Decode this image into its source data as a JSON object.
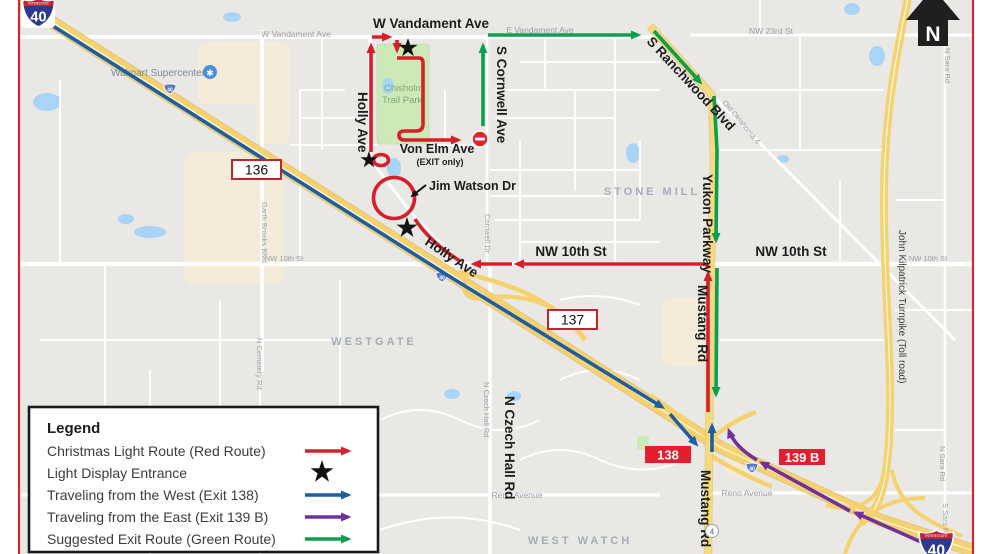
{
  "title": "Christmas light route map",
  "north_label": "N",
  "colors": {
    "red_route": "#d5202c",
    "blue_route": "#1b5ea6",
    "purple_route": "#7030a0",
    "green_route": "#0c9f4d",
    "highway_yellow": "#f6d26e",
    "exit_badge_red": "#e41e2d",
    "map_frame_red": "#cc2b31",
    "water_blue": "#a8d5f5",
    "park_green": "#cdeab6"
  },
  "shields": {
    "interstate_word": "INTERSTATE",
    "i40": "40",
    "box136": "136",
    "box137": "137",
    "exit138": "138",
    "exit139b": "139 B",
    "route4": "4"
  },
  "streets": {
    "w_vandament": "W Vandament Ave",
    "e_vandament": "E Vandament Ave",
    "nw23rd": "NW 23rd St",
    "s_cornwell": "S Cornwell Ave",
    "cornwell_dr": "Cornwell Dr",
    "s_ranchwood": "S Ranchwood Blvd",
    "old_oklahoma4": "Old Oklahoma 4",
    "n_sara": "N Sara Rd",
    "s_sara": "S Sara Rd",
    "holly": "Holly Ave",
    "von_elm": "Von Elm Ave",
    "exit_only": "(EXIT only)",
    "jim_watson": "Jim Watson Dr",
    "garth_brooks": "Garth Brooks Blvd",
    "nw10th": "NW 10th St",
    "yukon_parkway": "Yukon Parkway",
    "mustang_rd": "Mustang Rd",
    "kilpatrick": "John Kilpatrick Turnpike (Toll road)",
    "czech_hall": "N Czech Hall Rd",
    "cemetery": "N Cemetery Rd",
    "reno": "Reno Avenue"
  },
  "pois": {
    "walmart": "Walmart Supercenter",
    "park_line1": "Chisholm",
    "park_line2": "Trail Park"
  },
  "areas": {
    "stone_mill": "STONE MILL",
    "westgate": "WESTGATE",
    "west_watch": "WEST WATCH"
  },
  "legend": {
    "title": "Legend",
    "items": [
      {
        "label": "Christmas Light Route (Red Route)",
        "symbol": "red-arrow",
        "color": "#d5202c"
      },
      {
        "label": "Light Display Entrance",
        "symbol": "black-star",
        "color": "#111111"
      },
      {
        "label": "Traveling from the West (Exit 138)",
        "symbol": "blue-arrow",
        "color": "#1b5ea6"
      },
      {
        "label": "Traveling from the East (Exit 139 B)",
        "symbol": "purple-arrow",
        "color": "#7030a0"
      },
      {
        "label": "Suggested Exit Route (Green Route)",
        "symbol": "green-arrow",
        "color": "#0c9f4d"
      }
    ]
  }
}
